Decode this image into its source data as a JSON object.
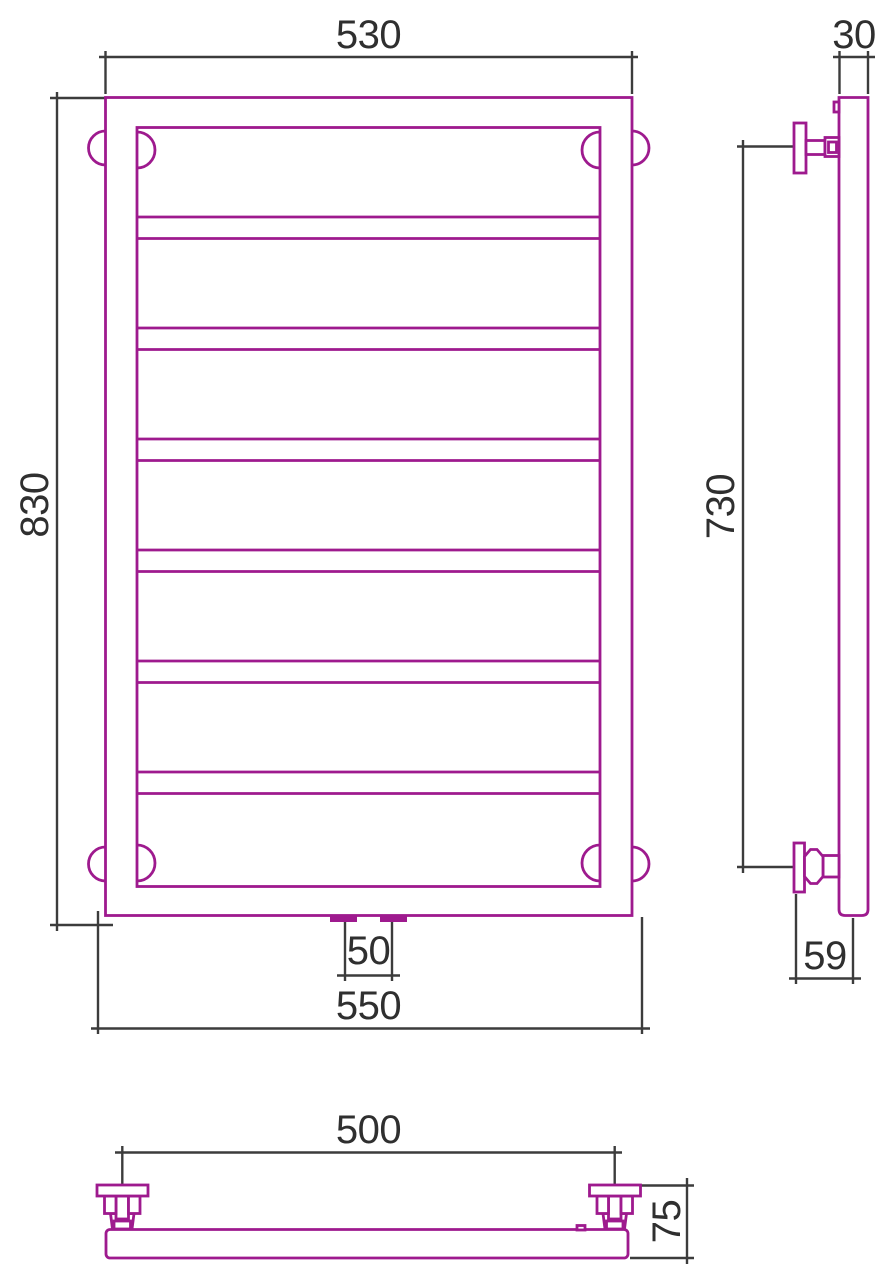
{
  "colors": {
    "product_line": "#9E1A8E",
    "dimension_line": "#3C3C3C",
    "text": "#2F2F2F",
    "background": "#FFFFFF"
  },
  "views": {
    "front": {
      "dimensions": {
        "width_top": "530",
        "height": "830",
        "width_bottom": "550",
        "connection_spacing": "50"
      }
    },
    "side": {
      "dimensions": {
        "depth": "30",
        "bracket_span": "730",
        "wall_to_axis": "59"
      }
    },
    "bottom": {
      "dimensions": {
        "bracket_spacing": "500",
        "depth": "75"
      }
    }
  }
}
